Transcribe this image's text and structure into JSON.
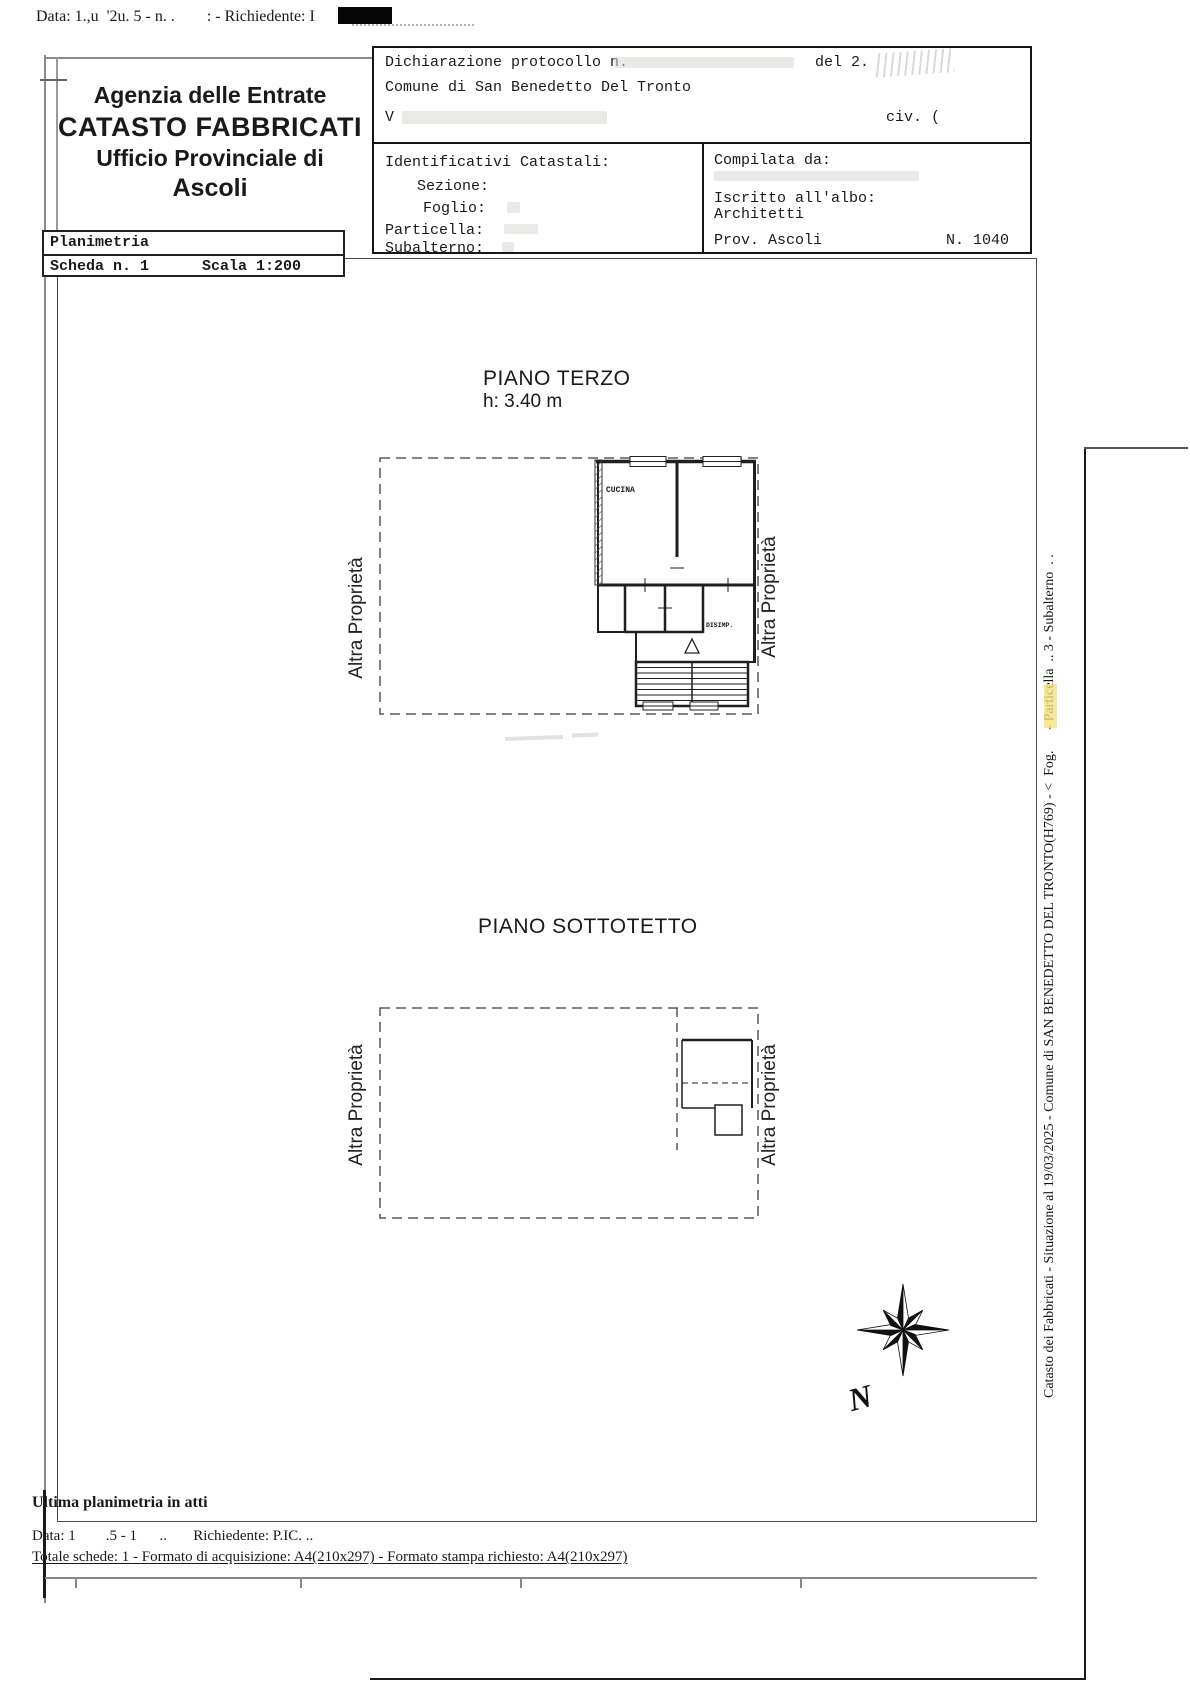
{
  "top": {
    "data_line": "Data: 1.,u  '2u. 5 - n. .        : - Richiedente: I"
  },
  "header": {
    "line1": "Agenzia delle Entrate",
    "line2": "CATASTO FABBRICATI",
    "line3": "Ufficio Provinciale di",
    "line4": "Ascoli"
  },
  "schede": {
    "planimetria": "Planimetria",
    "scheda": "Scheda n. 1",
    "scala": "Scala 1:200"
  },
  "protocollo": {
    "riga1": "Dichiarazione protocollo n.",
    "del": "del 2.",
    "comune": "Comune di San Benedetto Del Tronto",
    "via": "V",
    "civ": "civ. ("
  },
  "identificativi": {
    "titolo": "Identificativi Catastali:",
    "sezione": "Sezione:",
    "foglio": "Foglio:",
    "particella": "Particella:",
    "subalterno": "Subalterno:"
  },
  "compilata": {
    "label": "Compilata da:",
    "albo": "Iscritto all'albo:",
    "albo_value": "Architetti",
    "prov": "Prov. Ascoli",
    "num": "N. 1040"
  },
  "piani": {
    "terzo_titolo": "PIANO TERZO",
    "terzo_h": "h: 3.40 m",
    "cucina": "CUCINA",
    "disimp": "DISIMP.",
    "sottotetto_titolo": "PIANO SOTTOTETTO",
    "altra": "Altra Proprietà"
  },
  "sidebar": {
    "testo": "Catasto dei Fabbricati - Situazione al 19/03/2025 - Comune di SAN BENEDETTO DEL TRONTO(H769) - <  Fog.      - Particella  .. 3 - Subalterno  . .",
    "nord": "N"
  },
  "footer": {
    "ultima": "Ultima planimetria in atti",
    "data_line": "Data: 1        .5 - 1      ..       Richiedente: P.IC. ..",
    "totale": "Totale schede: 1 - Formato di acquisizione: A4(210x297)  - Formato stampa richiesto: A4(210x297)"
  }
}
